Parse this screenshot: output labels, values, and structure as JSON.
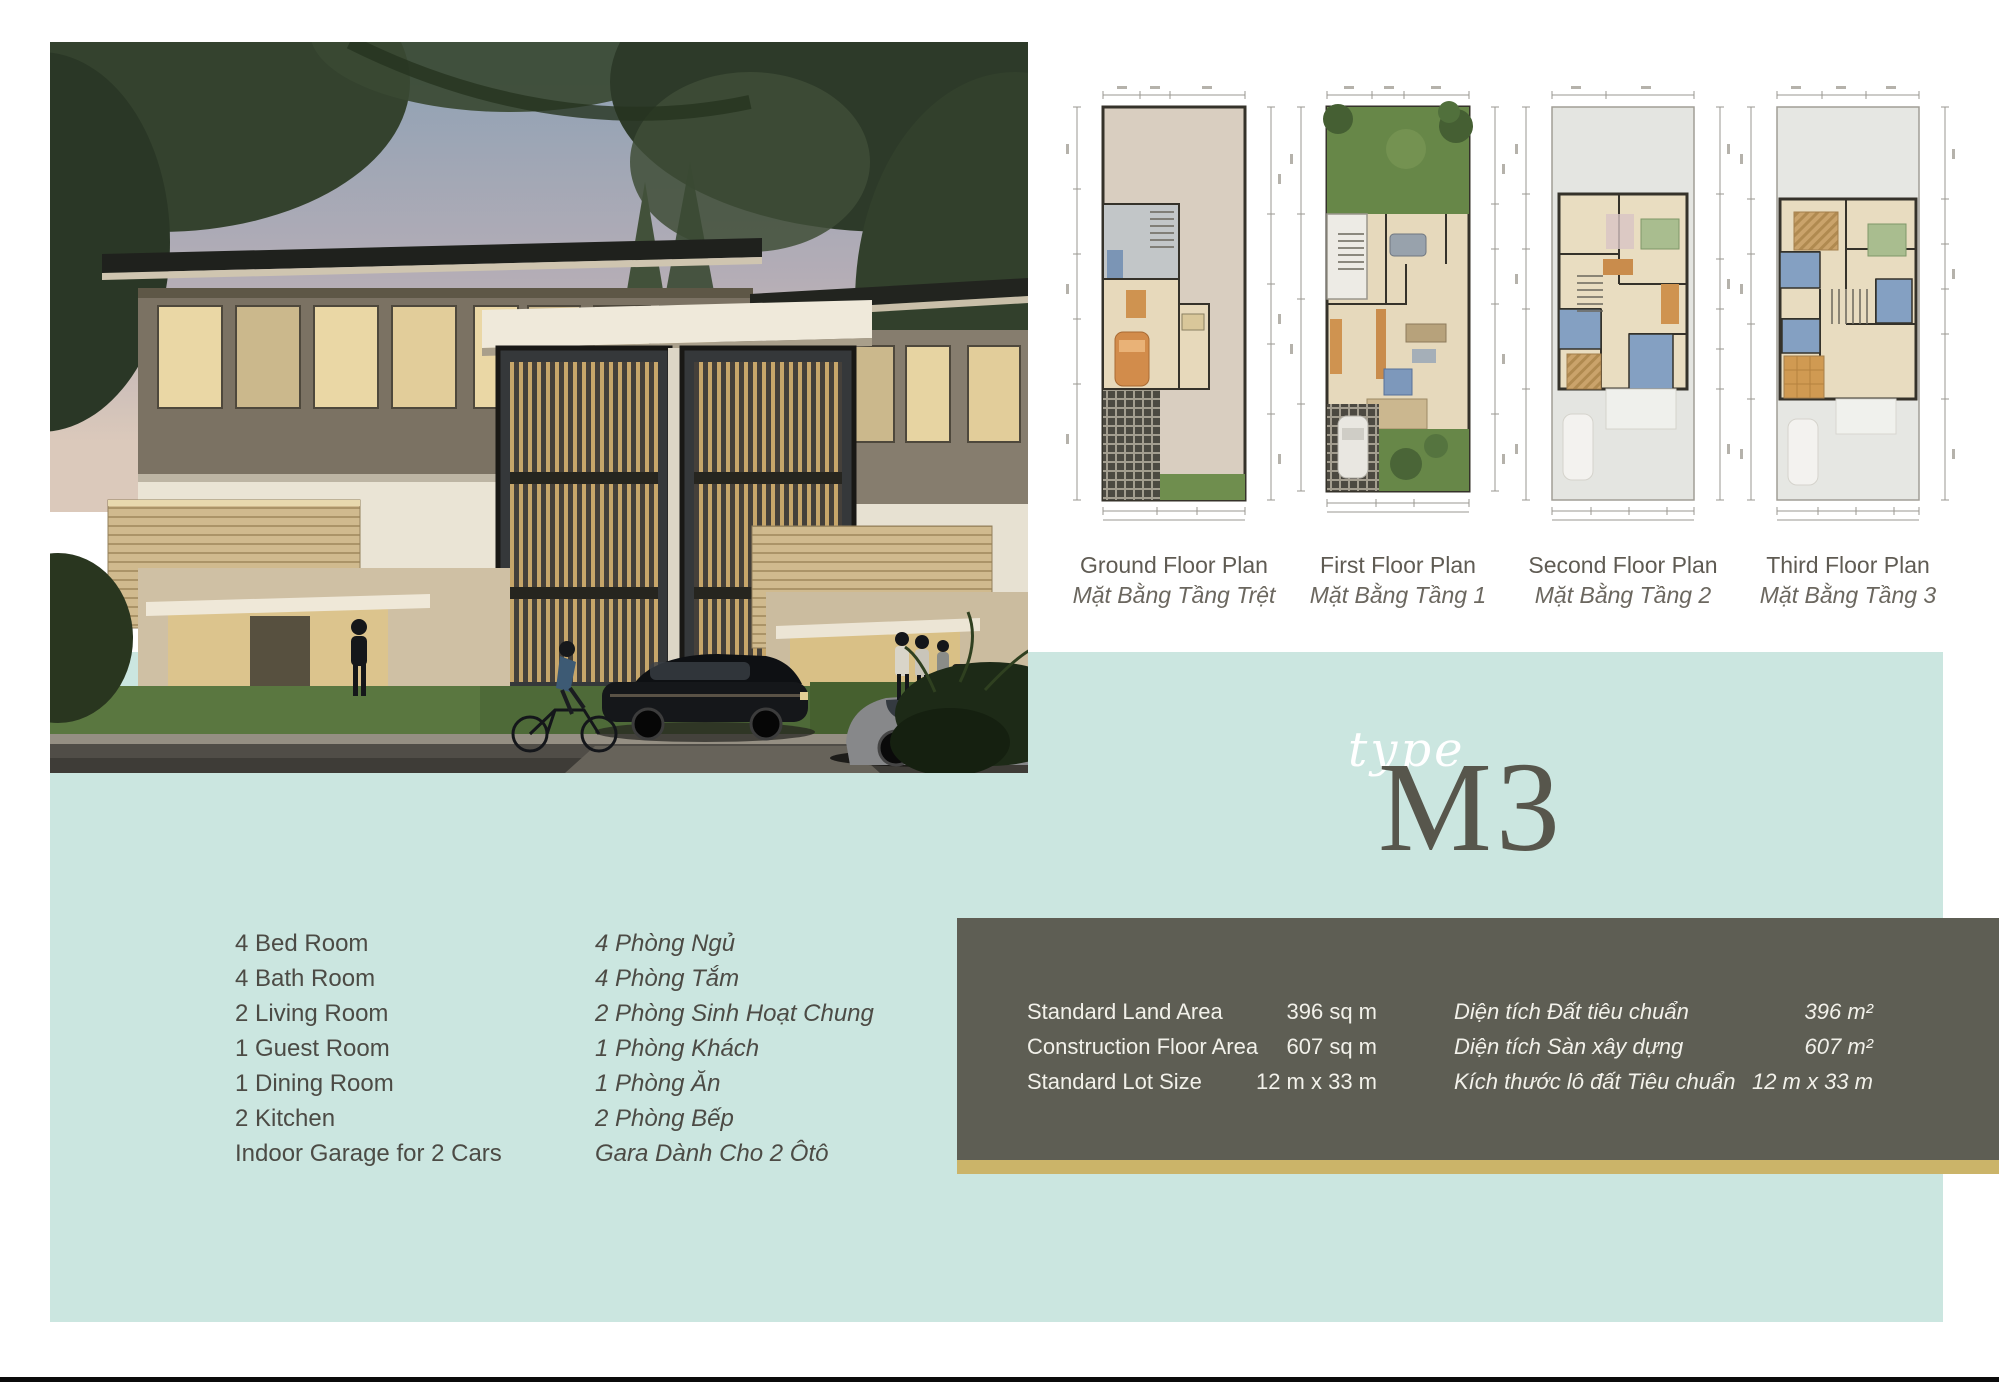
{
  "theme": {
    "background": "#ffffff",
    "panel_teal": "#cbe6e0",
    "spec_box": "#5e5e54",
    "gold_stripe": "#cbb469",
    "heading_gray": "#57564c",
    "text_gray": "#4c4b45",
    "caption_gray": "#6b675f"
  },
  "type_label": {
    "script": "type",
    "code": "M3"
  },
  "floor_plans": [
    {
      "title": "Ground Floor Plan",
      "subtitle": "Mặt Bằng Tầng Trệt"
    },
    {
      "title": "First Floor Plan",
      "subtitle": "Mặt Bằng Tầng 1"
    },
    {
      "title": "Second Floor Plan",
      "subtitle": "Mặt Bằng Tầng 2"
    },
    {
      "title": "Third Floor Plan",
      "subtitle": "Mặt Bằng Tầng 3"
    }
  ],
  "features": [
    {
      "en": "4 Bed Room",
      "vi": "4 Phòng Ngủ"
    },
    {
      "en": "4 Bath Room",
      "vi": "4 Phòng Tắm"
    },
    {
      "en": "2 Living Room",
      "vi": "2 Phòng Sinh Hoạt Chung"
    },
    {
      "en": "1 Guest Room",
      "vi": "1 Phòng Khách"
    },
    {
      "en": "1 Dining Room",
      "vi": "1 Phòng Ăn"
    },
    {
      "en": "2 Kitchen",
      "vi": "2 Phòng Bếp"
    },
    {
      "en": "Indoor Garage for 2 Cars",
      "vi": "Gara Dành Cho 2 Ôtô"
    }
  ],
  "specs": [
    {
      "label_en": "Standard Land Area",
      "value_en": "396 sq m",
      "label_vi": "Diện tích Đất tiêu chuẩn",
      "value_vi": "396 m²"
    },
    {
      "label_en": "Construction Floor Area",
      "value_en": "607 sq m",
      "label_vi": "Diện tích Sàn xây dựng",
      "value_vi": "607 m²"
    },
    {
      "label_en": "Standard Lot Size",
      "value_en": "12 m x 33 m",
      "label_vi": "Kích thước lô đất Tiêu chuẩn",
      "value_vi": "12 m x 33 m"
    }
  ]
}
